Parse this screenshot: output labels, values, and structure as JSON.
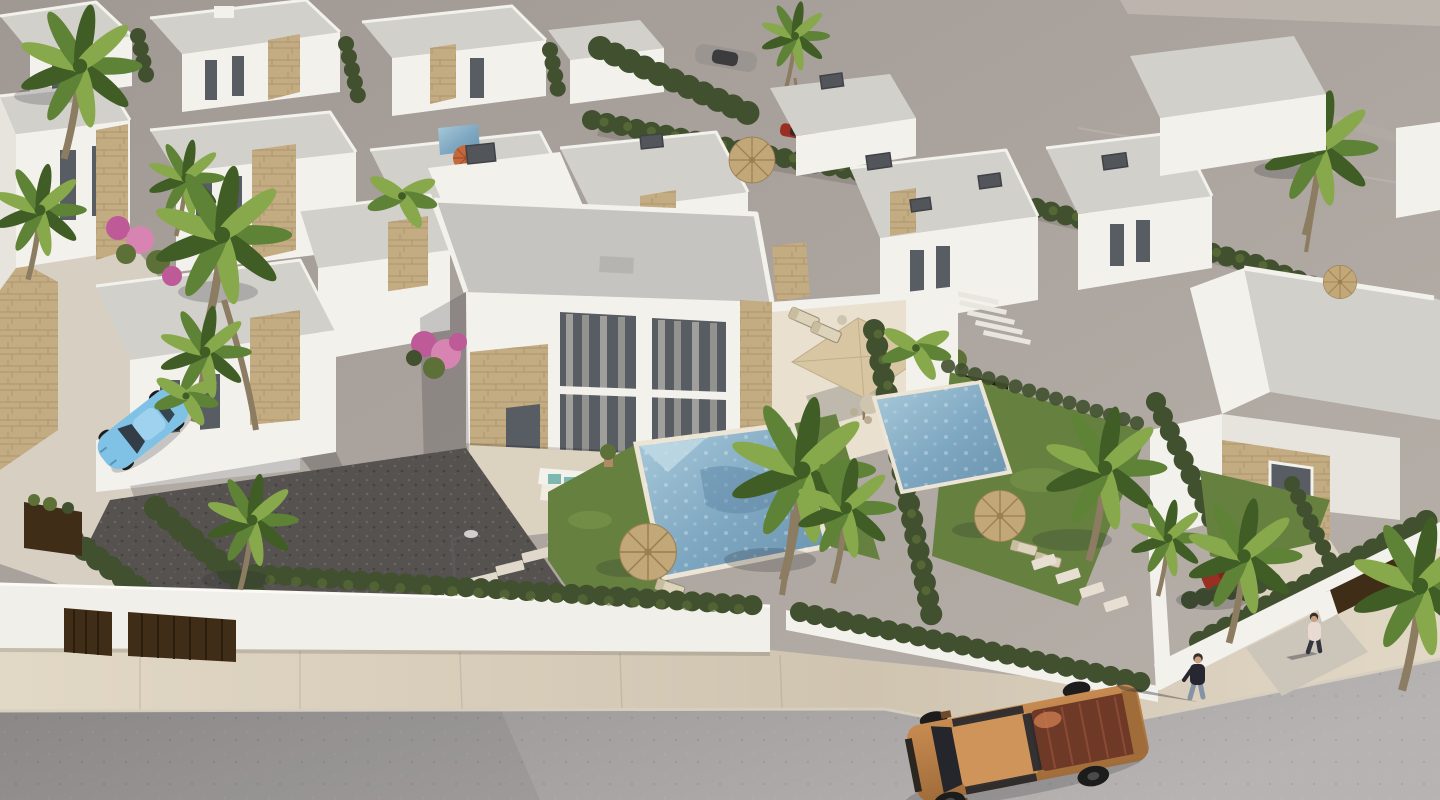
{
  "meta": {
    "description": "Aerial 3D architectural rendering of a modern white villa development: flat-roof houses with stone cladding, private pools, lawns, palm trees and hedges; a street in the foreground with a tan pickup truck, a parked light-blue car and two pedestrians; vacant grey terrain behind the plots.",
    "width": 1440,
    "height": 800
  },
  "palette": {
    "terrain_a": "#a09892",
    "terrain_b": "#aba39d",
    "terrain_c": "#b9b2ab",
    "road_a": "#8f8c8b",
    "road_b": "#a5a2a1",
    "road_c": "#b6b3b2",
    "side_a": "#cfc4b0",
    "side_b": "#e2d8c6",
    "wall_white": "#f3f1ec",
    "wall_face": "#e7e4de",
    "wall_shadow": "#c9c6c0",
    "roof": "#c6c4c0",
    "roof_light": "#d2d0cb",
    "roof_side": "#b2b0ac",
    "stone": "#c3ab82",
    "stone_dark": "#9d8560",
    "glass": "#585c63",
    "curtain": "#b9b5ad",
    "hedge": "#41502f",
    "hedge_light": "#5c7038",
    "hedge_dark": "#2d3a1f",
    "lawn": "#66813f",
    "lawn_light": "#7d9a4e",
    "gravel": "#565250",
    "pool": "#7ea7c1",
    "pool_light": "#aacbdb",
    "pool_deep": "#6a92ae",
    "palm": "#5e8336",
    "palm_dark": "#405d25",
    "palm_light": "#87a94c",
    "trunk": "#8c7c61",
    "thatch": "#c2a778",
    "thatch_dark": "#9a7f52",
    "parasol": "#d8c6a2",
    "umbrella_orange": "#c4693c",
    "corten": "#3f2d17",
    "corten_dark": "#2a1d0e",
    "truck_body": "#c78b51",
    "truck_dark": "#a06c3a",
    "truck_bed": "#6f3927",
    "truck_glass": "#24262b",
    "car_blue": "#7fc2e5",
    "car_red": "#992e22",
    "car_grey": "#9a9591",
    "skin": "#c9a083",
    "hair": "#3a2e26",
    "shirt_dark": "#282630",
    "jeans": "#8493a5",
    "shirt_light": "#e9dad3",
    "flower_a": "#bf5a98",
    "flower_b": "#d884b2",
    "chimney": "#52555a",
    "deck": "#dcd2c0",
    "deck_light": "#e9e0cf",
    "kerb": "#d6cec0",
    "shadow_c": "rgba(40,40,50,0.22)",
    "shadow_d": "rgba(40,40,50,0.38)"
  },
  "scene": {
    "setting": "aerial-3d-render-villa-development",
    "sun_direction": "upper-right",
    "environment": {
      "vacant_terrain": true,
      "access_road": true,
      "sidewalk": true
    },
    "buildings": {
      "main_villa": {
        "storeys": 2,
        "roof": "flat",
        "features": [
          "glass-facade",
          "stone-cladding",
          "covered-porch",
          "roof-parapet",
          "roof-chimney"
        ]
      },
      "back_row_villas": 4,
      "left_row_villas": 3,
      "right_villas": 3,
      "far_right_villa": 1
    },
    "garden": {
      "pools": 3,
      "lawns": 2,
      "thatch_umbrellas": 4,
      "orange_umbrella": 1,
      "dining_parasol": 1,
      "sun_loungers": 6,
      "outdoor_sofa": 1,
      "stepping_stones": 10,
      "street_lamp": 1,
      "hedges": true,
      "palm_trees": 12,
      "banana_plants": 3,
      "bougainvillea_clusters": 3
    },
    "street": {
      "vehicles": {
        "pickup_truck": "tan",
        "parked_car": "light-blue",
        "distant_cars": 3
      },
      "pedestrians": 2,
      "gates": {
        "front_corten_gates": 2,
        "right_corten_gate": 1,
        "corten_planter": 1
      }
    }
  }
}
